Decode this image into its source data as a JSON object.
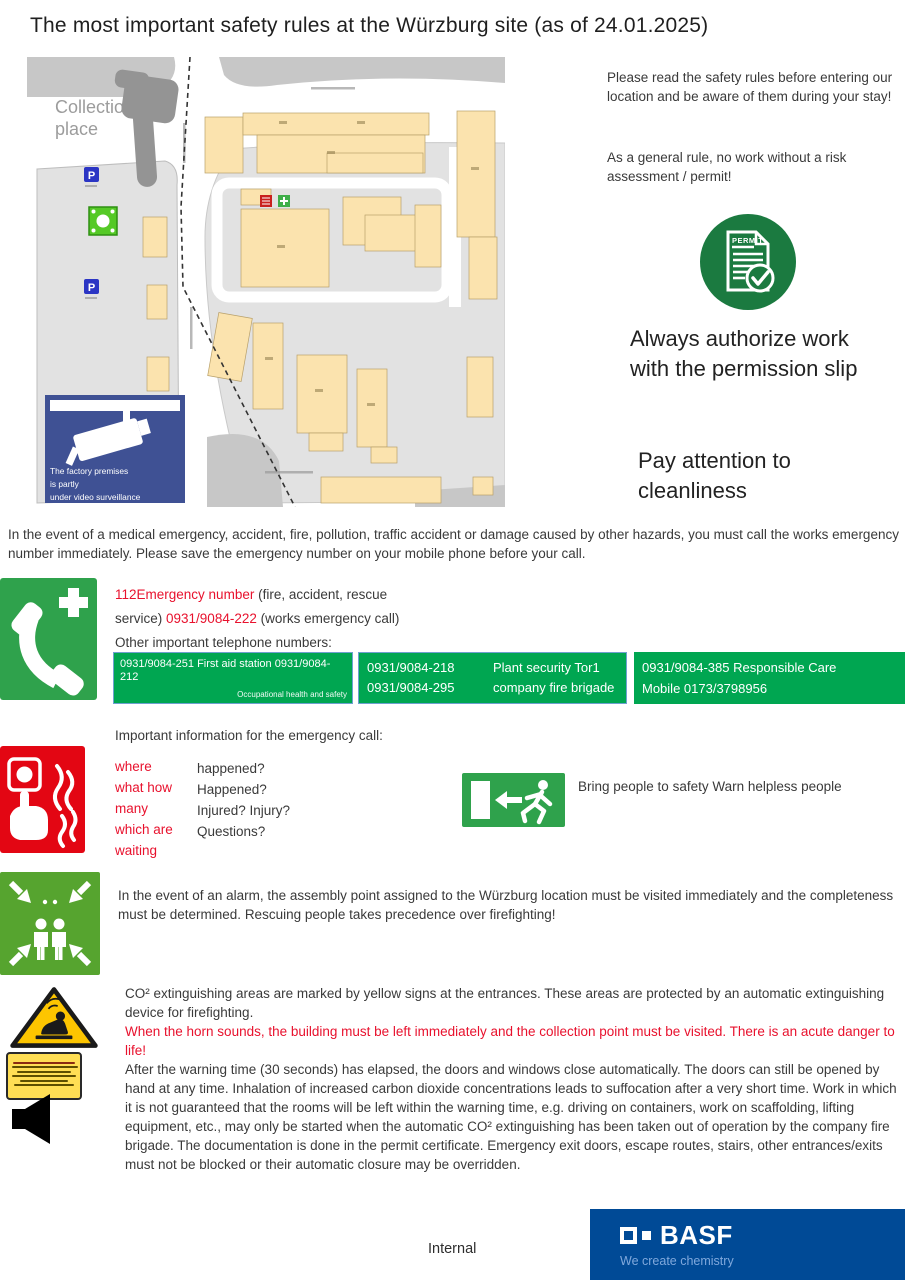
{
  "title": "The most important safety rules at the Würzburg site (as of 24.01.2025)",
  "map": {
    "collection_line1": "Collection",
    "collection_line2": "place",
    "parking_label": "P",
    "surveillance": {
      "line1": "The factory premises",
      "line2": "is partly",
      "line3": "under video surveillance"
    }
  },
  "intro": {
    "read_rules": "Please read the safety rules before entering our location and be aware of them during your stay!",
    "general_rule": "As a general rule, no work without a risk assessment / permit!",
    "permit_label": "PERMIT",
    "authorize": "Always authorize work with the permission slip",
    "cleanliness": "Pay attention to cleanliness"
  },
  "emergency": {
    "intro": "In the event of a medical emergency, accident, fire, pollution, traffic accident or damage caused by other hazards, you must call the works emergency number immediately. Please save the emergency number on your mobile phone before your call.",
    "part1_red": "112Emergency number",
    "part2": " (fire, accident, rescue service) ",
    "part3_red": "0931/9084-222",
    "part4": " (works emergency call) Other important telephone numbers:",
    "table": {
      "first_aid_main": "0931/9084-251 First aid station 0931/9084-212",
      "first_aid_sub": "Occupational health and safety",
      "security_num1": "0931/9084-218",
      "security_num2": "0931/9084-295",
      "security_label1": "Plant security Tor1",
      "security_label2": "company fire brigade",
      "care_line1": "0931/9084-385 Responsible Care",
      "care_line2": "Mobile 0173/3798956"
    }
  },
  "call_info": {
    "heading": "Important information for the emergency call:",
    "left": [
      "where",
      "what how",
      "many",
      "which are",
      "waiting"
    ],
    "right": [
      "happened?",
      "Happened?",
      "Injured? Injury?",
      "Questions?"
    ],
    "rescue_note": "Bring people to safety Warn helpless people"
  },
  "assembly": {
    "text": "In the event of an alarm, the assembly point assigned to the Würzburg location must be visited immediately and the completeness must be determined. Rescuing people takes precedence over firefighting!"
  },
  "co2": {
    "p1": "CO² extinguishing areas are marked by yellow signs at the entrances. These areas are protected by an automatic extinguishing device for firefighting.",
    "warning": "When the horn sounds, the building must be left immediately and the collection point must be visited. There is an acute danger to life!",
    "p2": "After the warning time (30 seconds) has elapsed, the doors and windows close automatically. The doors can still be opened by hand at any time. Inhalation of increased carbon dioxide concentrations leads to suffocation after a very short time. Work in which it is not guaranteed that the rooms will be left within the warning time, e.g. driving on containers, work on scaffolding, lifting equipment, etc., may only be started when the automatic CO² extinguishing has been taken out of operation by the company fire brigade. The documentation is done in the permit certificate. Emergency exit doors, escape routes, stairs, other entrances/exits must not be blocked or their automatic closure may be overridden."
  },
  "footer": {
    "internal": "Internal",
    "basf": "BASF",
    "tagline": "We create chemistry"
  },
  "colors": {
    "safety_green": "#00A651",
    "icon_green": "#2FA24C",
    "permit_green": "#1B7A40",
    "alert_red": "#E8112D",
    "fire_red": "#E30613",
    "warning_yellow": "#FDC500",
    "sign_blue": "#3F5194",
    "basf_blue": "#004A96",
    "basf_lightblue": "#7FA8DC"
  }
}
